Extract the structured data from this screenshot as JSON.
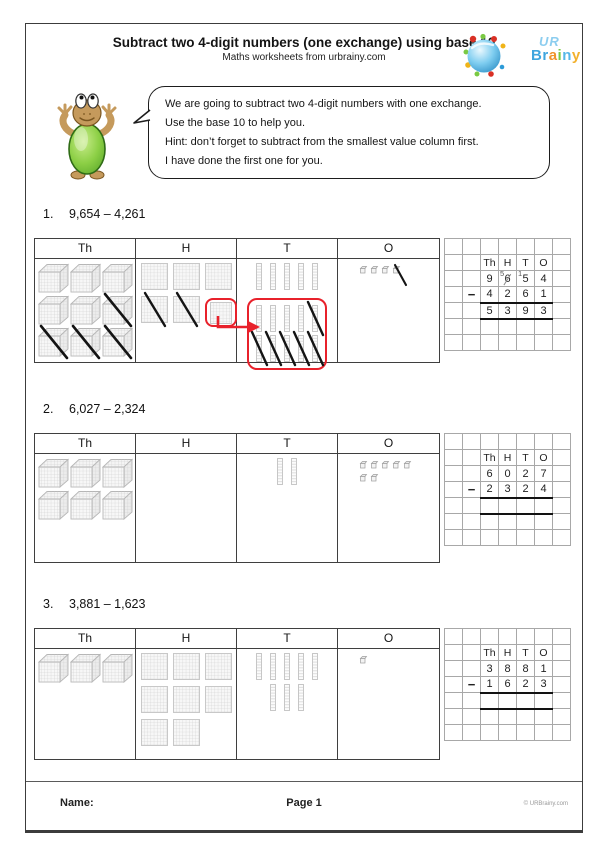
{
  "header": {
    "title": "Subtract two 4-digit numbers (one exchange) using base 10",
    "subtitle": "Maths worksheets from urbrainy.com"
  },
  "logo": {
    "ur": "UR",
    "brainy": "Brainy",
    "brainy_colors": [
      "#3fa5de",
      "#3fa5de",
      "#f0932c",
      "#7ac943",
      "#56b7e8",
      "#f2b12e"
    ],
    "sphere_color": "#5cb6e4",
    "accent_red": "#e8212b"
  },
  "speech": {
    "lines": [
      "We are going to subtract two 4-digit numbers with one exchange.",
      "Use the base 10 to help you.",
      "Hint: don’t forget to subtract from the smallest value column first.",
      "I have done the first one for you."
    ]
  },
  "questions": [
    {
      "number": "1.",
      "expression": "9,654 – 4,261",
      "columns": [
        "Th",
        "H",
        "T",
        "O"
      ],
      "blocks": {
        "Th": {
          "type": "cube",
          "rows": [
            [
              "n",
              "n",
              "n"
            ],
            [
              "n",
              "n",
              "x"
            ],
            [
              "x",
              "x",
              "x"
            ]
          ]
        },
        "H": {
          "type": "flat",
          "rows": [
            [
              "n",
              "n",
              "n"
            ],
            [
              "x",
              "x",
              "b"
            ]
          ]
        },
        "T": {
          "type": "rod",
          "rows": [
            [
              "n",
              "n",
              "n",
              "n",
              "n"
            ]
          ],
          "box_rows": [
            [
              "n",
              "n",
              "n",
              "n",
              "x"
            ],
            [
              "x",
              "x",
              "x",
              "x",
              "x"
            ]
          ]
        },
        "O": {
          "type": "unit",
          "rows": [
            [
              "n",
              "n",
              "n",
              "x"
            ]
          ]
        }
      },
      "has_exchange_arrow": true,
      "grid": {
        "headers": [
          "Th",
          "H",
          "T",
          "O"
        ],
        "minuend": [
          {
            "d": "9"
          },
          {
            "d": "6",
            "strike": true,
            "sup": "5"
          },
          {
            "d": "5",
            "sup": "1"
          },
          {
            "d": "4"
          }
        ],
        "minus": "−",
        "subtrahend": [
          "4",
          "2",
          "6",
          "1"
        ],
        "answer": [
          "5",
          "3",
          "9",
          "3"
        ]
      }
    },
    {
      "number": "2.",
      "expression": "6,027 – 2,324",
      "columns": [
        "Th",
        "H",
        "T",
        "O"
      ],
      "blocks": {
        "Th": {
          "type": "cube",
          "rows": [
            [
              "n",
              "n",
              "n"
            ],
            [
              "n",
              "n",
              "n"
            ]
          ]
        },
        "H": {
          "type": "flat",
          "rows": []
        },
        "T": {
          "type": "rod",
          "rows": [
            [
              "n",
              "n"
            ]
          ]
        },
        "O": {
          "type": "unit",
          "rows": [
            [
              "n",
              "n",
              "n",
              "n",
              "n"
            ],
            [
              "n",
              "n"
            ]
          ]
        }
      },
      "has_exchange_arrow": false,
      "grid": {
        "headers": [
          "Th",
          "H",
          "T",
          "O"
        ],
        "minuend": [
          {
            "d": "6"
          },
          {
            "d": "0"
          },
          {
            "d": "2"
          },
          {
            "d": "7"
          }
        ],
        "minus": "−",
        "subtrahend": [
          "2",
          "3",
          "2",
          "4"
        ],
        "answer": [
          "",
          "",
          "",
          ""
        ]
      }
    },
    {
      "number": "3.",
      "expression": "3,881 – 1,623",
      "columns": [
        "Th",
        "H",
        "T",
        "O"
      ],
      "blocks": {
        "Th": {
          "type": "cube",
          "rows": [
            [
              "n",
              "n",
              "n"
            ]
          ]
        },
        "H": {
          "type": "flat",
          "rows": [
            [
              "n",
              "n",
              "n"
            ],
            [
              "n",
              "n",
              "n"
            ],
            [
              "n",
              "n"
            ]
          ]
        },
        "T": {
          "type": "rod",
          "rows": [
            [
              "n",
              "n",
              "n",
              "n",
              "n"
            ],
            [
              "n",
              "n",
              "n"
            ]
          ]
        },
        "O": {
          "type": "unit",
          "rows": [
            [
              "n"
            ]
          ]
        }
      },
      "has_exchange_arrow": false,
      "grid": {
        "headers": [
          "Th",
          "H",
          "T",
          "O"
        ],
        "minuend": [
          {
            "d": "3"
          },
          {
            "d": "8"
          },
          {
            "d": "8"
          },
          {
            "d": "1"
          }
        ],
        "minus": "−",
        "subtrahend": [
          "1",
          "6",
          "2",
          "3"
        ],
        "answer": [
          "",
          "",
          "",
          ""
        ]
      }
    }
  ],
  "footer": {
    "name_label": "Name:",
    "page_label": "Page 1",
    "copyright": "© URBrainy.com"
  }
}
